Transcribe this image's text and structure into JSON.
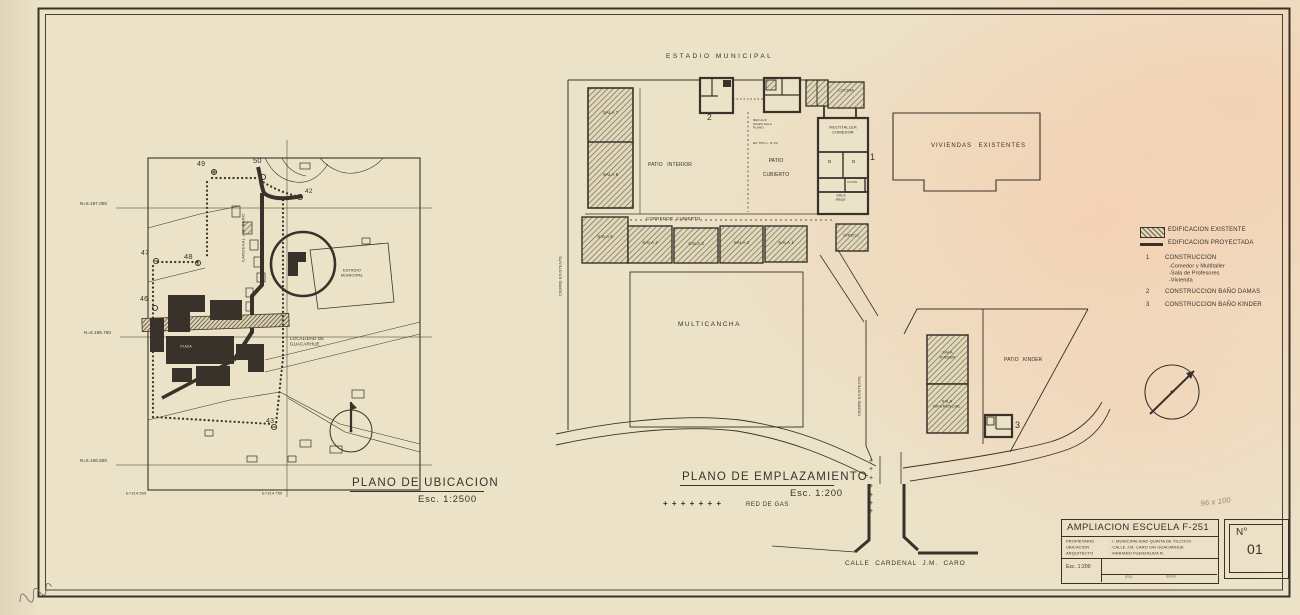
{
  "ubicacion": {
    "title": "PLANO DE UBICACION",
    "scale": "Esc. 1:2500",
    "n_top": "N=6.197.000",
    "n_mid": "N=6.196.750",
    "n_bot": "N=6.196.500",
    "e_left": "E=314.500",
    "e_right": "E=314.750",
    "estadio": "ESTADIO\nMUNICIPAL",
    "localidad": "LOCALIDAD DE\nGUACARHUE",
    "plaza": "PLAZA",
    "street": "CARDENAL J.M. CARO",
    "n49": "49",
    "n50": "50",
    "n42": "42",
    "n47": "47",
    "n48": "48",
    "n46": "46",
    "n43": "43"
  },
  "emplazamiento": {
    "title": "PLANO DE EMPLAZAMIENTO",
    "scale": "Esc. 1:200",
    "estadio": "ESTADIO  MUNICIPAL",
    "sala7": "SALA 7",
    "sala6": "SALA 6",
    "sala5": "SALA 5",
    "sala4": "SALA 4",
    "sala3": "SALA 3",
    "sala2": "SALA 2",
    "sala1": "SALA 1",
    "patio_interior": "PATIO  INTERIOR",
    "patio_cubierto": "PATIO\nCUBIERTO",
    "corredor": "CORREDOR  CUBIERTO",
    "multitaller": "MULTITALLER\nCOMEDOR",
    "cocina": "COCINA",
    "cocin": "COCIN.",
    "d1": "D",
    "d2": "D",
    "sala_prof": "SALA\nPROF.",
    "direcc": "DIRECC.",
    "multicancha": "MULTICANCHA",
    "viviendas": "VIVIENDAS  EXISTENTES",
    "sala_kinder": "SALA\nKINDER",
    "sala_diferencial": "SALA\nDIFERENCIAL",
    "patio_kinder": "PATIO  KINDER",
    "cierre": "CIERRE  EXISTENTE",
    "ann1": "RED AUX\nINCEN SALA\nPLANO",
    "ann2": "EN TIPO L. B 1/2",
    "m1": "1",
    "m2": "2",
    "m3": "3",
    "gas_plus": "+ + + + + + +",
    "gas_plus_v": "+\n+\n+\n+\n+\n+\n+",
    "gas_label": "RED DE GAS",
    "calle": "CALLE CARDENAL J.M. CARO"
  },
  "legend": {
    "existing": "EDIFICACION EXISTENTE",
    "projected": "EDIFICACION PROYECTADA",
    "n1num": "1",
    "n1": "CONSTRUCCION",
    "n1a": "-Comedor y Multitaller",
    "n1b": "-Sala de Profesores",
    "n1c": "-Vivienda",
    "n2num": "2",
    "n2": "CONSTRUCCION BAÑO DAMAS",
    "n3num": "3",
    "n3": "CONSTRUCCION BAÑO KINDER"
  },
  "titleblock": {
    "title": "AMPLIACION ESCUELA F-251",
    "r1l": "PROPIETARIO",
    "r1v": ": I. MUNICIPALIDAD QUINTA DE TILCOCO",
    "r2l": "UBICACION",
    "r2v": ": CALLE J.M. CARO S/N GUACARHUE",
    "r3l": "ARQUITECTO",
    "r3v": ": MARIANO FUENZALIDA R.",
    "scale": "Esc. 1:200",
    "small_left": "prop.",
    "small_right": "dicbre.",
    "sheet_label": "N°",
    "sheet_number": "01",
    "handwritten": "96 x 100"
  },
  "colors": {
    "paper": "#ebe2c8",
    "ink": "#38322a",
    "tint": "#f7dfc9"
  }
}
